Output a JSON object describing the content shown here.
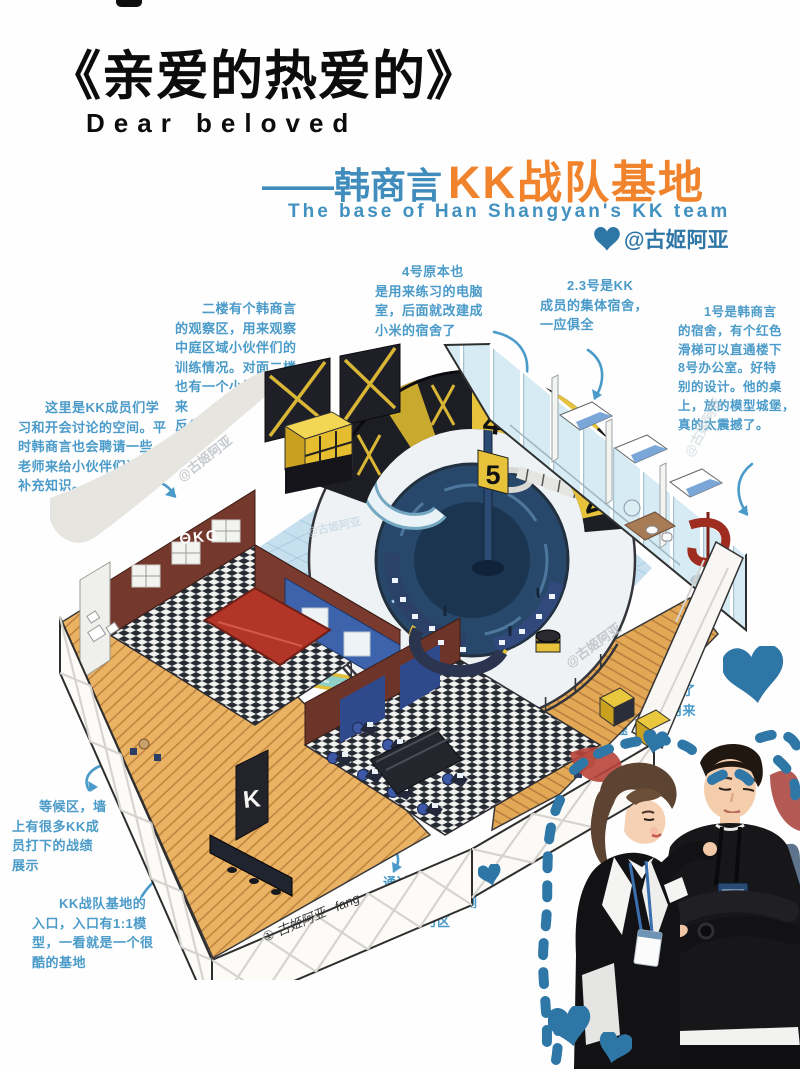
{
  "header": {
    "title_cn": "《亲爱的热爱的》",
    "title_en": "Dear beloved",
    "sub_dash": "——韩商言",
    "sub_kk": "KK战队基地",
    "sub_en": "The base of Han Shangyan's KK team",
    "credit": "@古姬阿亚"
  },
  "colors": {
    "annotation_blue": "#4a9bc9",
    "deep_blue": "#2e76a6",
    "orange": "#f0832b",
    "header_blue": "#3f8cbd",
    "hazard_yellow": "#e6c33b",
    "wood": "#eab263",
    "tile_blue": "#c7e0ef",
    "pit_navy": "#27486a",
    "table_red": "#b23527"
  },
  "annotations": {
    "study": {
      "text": "　　这里是KK成员们学\n习和开会讨论的空间。平\n时韩商言也会聘请一些\n老师来给小伙伴们讲课，\n补充知识。"
    },
    "observe": {
      "text": "　　二楼有个韩商言\n的观察区，用来观察\n中庭区域小伙伴们的\n训练情况。对面二楼\n也有一个小黑屋，用来\n反省。"
    },
    "room4": {
      "text": "　　4号原本也\n是用来练习的电脑\n室，后面就改建成\n小米的宿舍了"
    },
    "dorm23": {
      "text": "　　2.3号是KK\n成员的集体宿舍，\n一应俱全"
    },
    "room1": {
      "text": "　　1号是韩商言\n的宿舍，有个红色\n滑梯可以直通楼下\n8号办公室。好特\n别的设计。他的桌\n上，放的模型城堡，\n真的太震撼了。"
    },
    "tea": {
      "text": "　　茶水区，放了\n游戏机，平时用来\n练手速"
    },
    "waiting": {
      "text": "　　等候区，墙\n上有很多KK成\n员打下的战绩\n展示"
    },
    "entrance": {
      "text": "　　KK战队基地的\n入口，入口有1:1模\n型，一看就是一个很\n酷的基地"
    },
    "corridor": {
      "text": "　　通过一个时空\n隧道般的过道，右侧\n也是一个练习区"
    }
  },
  "illustration": {
    "doors": {
      "d5": "5",
      "d4": "4",
      "d3": "3",
      "d2": "2"
    },
    "graffiti": "ΘKG",
    "entry_letter": "K",
    "signature": "① 古姬阿亚 ~fang",
    "watermark": "@古姬阿亚"
  }
}
